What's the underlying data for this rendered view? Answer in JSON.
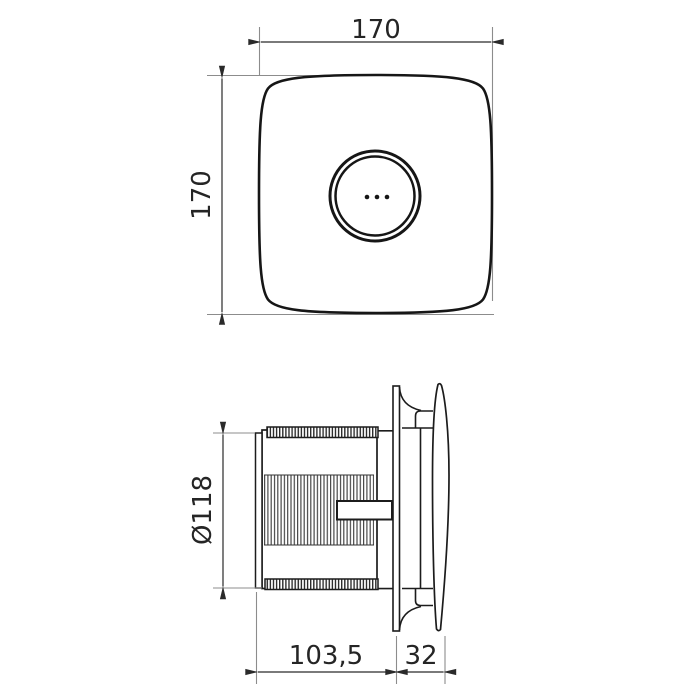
{
  "app": {
    "type": "technical-dimension-drawing",
    "background": "#ffffff"
  },
  "colors": {
    "outline": "#161616",
    "dimension_line": "#2a2a2a",
    "extension_line": "#8c8c8c",
    "text": "#252525"
  },
  "views": {
    "front": {
      "name": "fan-front-view",
      "dimensions": {
        "width": {
          "value": "170"
        },
        "height": {
          "value": "170"
        }
      }
    },
    "side": {
      "name": "fan-side-view",
      "dimensions": {
        "duct_diameter": {
          "value": "Ø118"
        },
        "body_depth": {
          "value": "103,5"
        },
        "cover_depth": {
          "value": "32"
        }
      }
    }
  }
}
